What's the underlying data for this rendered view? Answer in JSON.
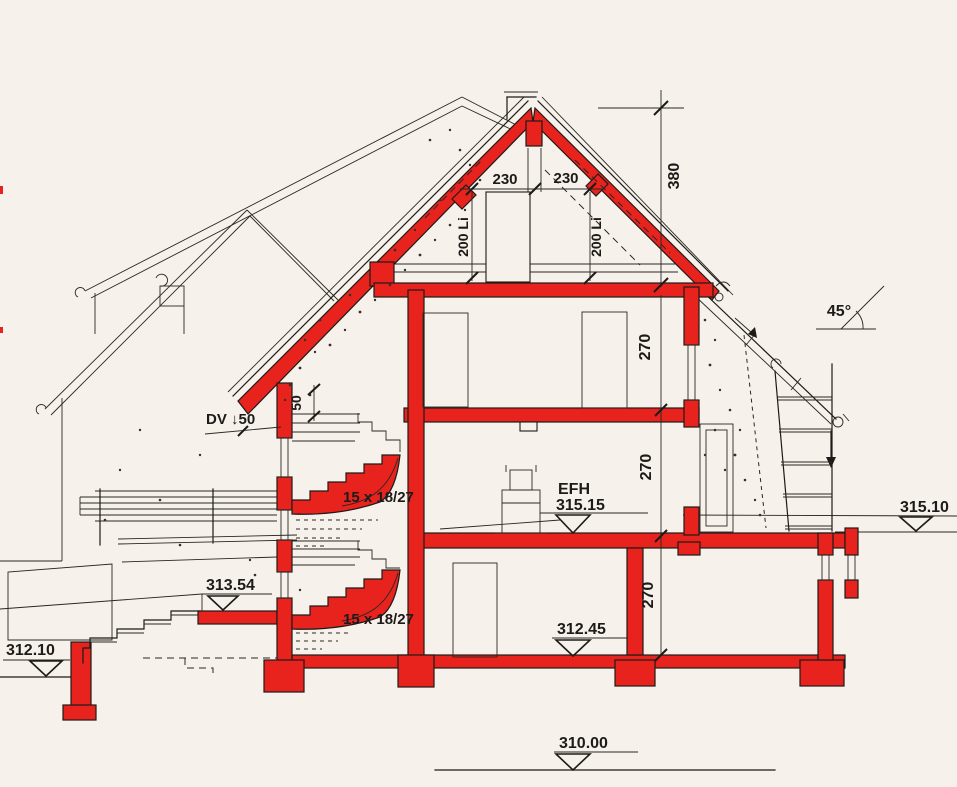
{
  "colors": {
    "paper": "#f6f1ea",
    "ink": "#1d1b19",
    "section_red": "#e8231d"
  },
  "labels": {
    "dim_230_left": "230",
    "dim_230_right": "230",
    "dim_ridge_height": "380",
    "dim_clear_left": "200 Li",
    "dim_clear_right": "200 Li",
    "dim_attic_floor": "270",
    "dim_upper_floor": "270",
    "dim_basement": "270",
    "roof_pitch": "45°",
    "eave_note": "DV ↓50",
    "dim_small": "50",
    "stairs_upper": "15 x 18/27",
    "stairs_lower": "15 x 18/27",
    "level_ground_floor_name": "EFH",
    "level_ground_floor": "315.15",
    "level_terrain_right": "315.10",
    "level_terrace_left": "313.54",
    "level_basement_floor": "312.45",
    "level_terrain_left": "312.10",
    "level_foundation": "310.00"
  }
}
